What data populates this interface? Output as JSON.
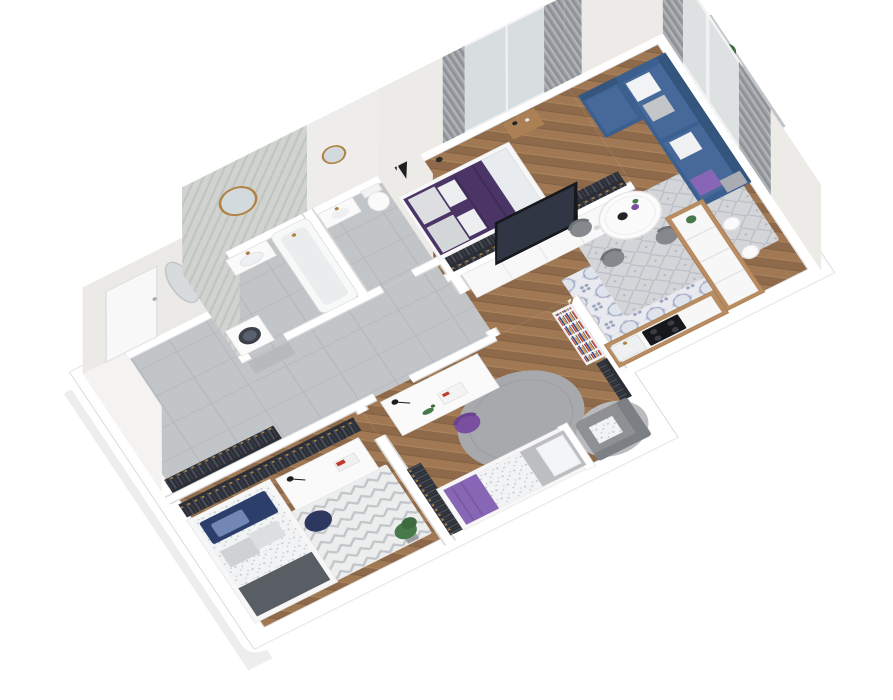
{
  "scene": {
    "kind": "3d-isometric-floorplan-render",
    "background": "#ffffff",
    "apartment": "2-bedroom + kids rooms apartment with open living/kitchen, bathroom, WC, hall and two balconies"
  },
  "colors": {
    "glass": "#c9d5db",
    "bed_master": "#4a3566",
    "bed_master_fold": "#e9ecef",
    "sofa": "#3b5f8f",
    "sofa_seat": "#46699a",
    "sofa_back": "#34557e",
    "blanket_kid": "#8767b5",
    "chair_purple": "#7a4fa0",
    "pillow_navy": "#2c3f6b",
    "pouf_navy": "#2d3860",
    "blanket_dark": "#595d64",
    "duvet_gray": "#bcbec1",
    "tv": "#17181c",
    "tv_screen": "#313644",
    "counter_wood": "#b98d62",
    "wood_furniture": "#ab8055",
    "plant": "#47794a",
    "plant_dark": "#3c6b3f",
    "brass": "#b08344",
    "chair_gray": "#85888c",
    "armchair": "#8e9094",
    "armchair_back": "#7c7f83",
    "bench": "#b7b9bc",
    "red_accent": "#c0392b"
  },
  "rooms": [
    {
      "id": "hall",
      "label": "entrance hall",
      "floor": "gray-tile",
      "items": [
        "entrance-door",
        "oval-mirror",
        "bench",
        "wardrobe-rack"
      ]
    },
    {
      "id": "bathroom",
      "label": "bathroom",
      "floor": "gray-tile",
      "items": [
        "herringbone-feature-wall",
        "round-gold-mirror",
        "vanity-sink",
        "bathtub",
        "washing-machine"
      ]
    },
    {
      "id": "wc",
      "label": "toilet room",
      "floor": "gray-tile",
      "items": [
        "mirror",
        "sink",
        "toilet"
      ]
    },
    {
      "id": "bedroom",
      "label": "master bedroom",
      "floor": "herringbone-wood",
      "items": [
        "double-bed-purple",
        "gray-pillows",
        "nightstand",
        "floor-lamp",
        "wall-frames",
        "wardrobe-rack",
        "balcony-door",
        "curtains",
        "balcony-plant"
      ]
    },
    {
      "id": "living",
      "label": "living room + kitchen",
      "floor": "herringbone-wood + patterned-tile",
      "items": [
        "tv-cabinet",
        "tv",
        "corner-sofa-blue",
        "pillows",
        "diamond-rug",
        "round-dining-table",
        "dining-chairs",
        "kitchen-counter-L",
        "cooktop",
        "kitchen-sink",
        "bar-stools",
        "balcony-door",
        "curtains",
        "balcony-tree"
      ]
    },
    {
      "id": "kid1",
      "label": "kids room (left)",
      "floor": "herringbone-wood",
      "items": [
        "single-bed-blue",
        "speckled-duvet",
        "desk-gold-legs",
        "desk-lamp",
        "books",
        "navy-pouf",
        "chevron-rug",
        "potted-plant",
        "wardrobe-racks"
      ]
    },
    {
      "id": "kid2",
      "label": "kids room (bottom)",
      "floor": "herringbone-wood",
      "items": [
        "desk",
        "desk-lamp",
        "magazine",
        "dinosaur-toy",
        "purple-chair",
        "round-gray-rug",
        "single-bed-purple-blanket",
        "bookshelf",
        "armchair",
        "wardrobe-racks"
      ]
    }
  ],
  "balconies": [
    {
      "id": "balcony-bedroom",
      "items": [
        "plant"
      ]
    },
    {
      "id": "balcony-living",
      "items": [
        "tree"
      ]
    }
  ]
}
